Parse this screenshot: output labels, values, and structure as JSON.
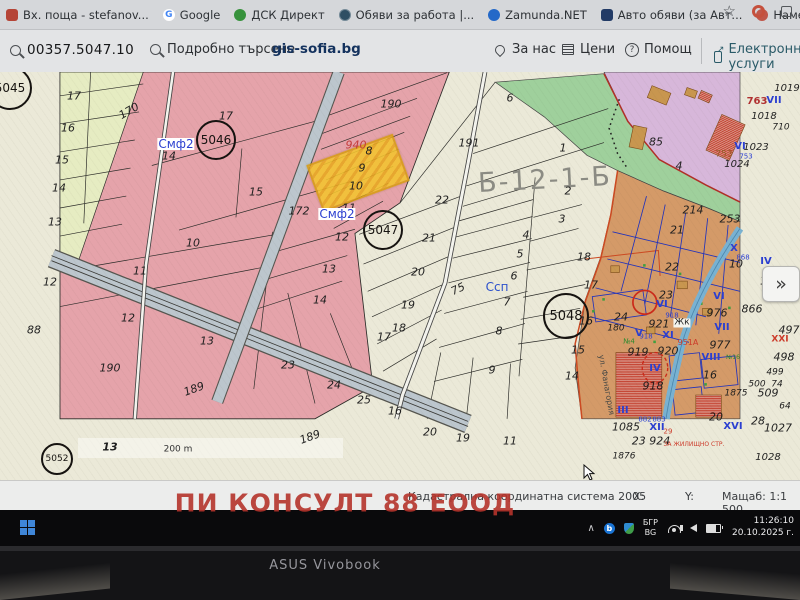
{
  "browser": {
    "bookmarks": [
      {
        "label": "Вх. поща - stefanov...",
        "icon": "mail-icon"
      },
      {
        "label": "Google",
        "icon": "google-icon",
        "glyph": "G"
      },
      {
        "label": "ДСК Директ",
        "icon": "dsk-icon"
      },
      {
        "label": "Обяви за работа |...",
        "icon": "globe-icon"
      },
      {
        "label": "Zamunda.NET",
        "icon": "zamunda-icon"
      },
      {
        "label": "Авто обяви (за Авт...",
        "icon": "auto-icon"
      },
      {
        "label": "Намери Обяви за...",
        "icon": "circle-icon"
      },
      {
        "label": "UBB - Online Banking",
        "icon": "ubb-icon",
        "glyph": "⚓"
      },
      {
        "label": "Единство",
        "icon": "edinstvo-icon"
      }
    ],
    "toolbar": {
      "star": "☆"
    }
  },
  "site_header": {
    "parcel_id": "00357.5047.10",
    "detailed_search": "Подробно търсене",
    "site_name": "gis-sofia.bg",
    "nav": [
      {
        "label": "За нас",
        "icon": "pin-icon"
      },
      {
        "label": "Цени",
        "icon": "doc-icon"
      },
      {
        "label": "Помощ",
        "icon": "help-icon",
        "glyph": "?"
      },
      {
        "label": "Електронни услуги",
        "icon": "ext-link-icon"
      }
    ]
  },
  "map": {
    "expand_button": "»",
    "scale_bar": "200 m",
    "zone_labels_note": "cadastral parcel annotations",
    "circles": [
      {
        "n": "5045",
        "x": 10,
        "y": 88,
        "r": 22,
        "f": 12
      },
      {
        "n": "5046",
        "x": 216,
        "y": 140,
        "r": 20,
        "f": 12
      },
      {
        "n": "5047",
        "x": 383,
        "y": 230,
        "r": 20,
        "f": 12
      },
      {
        "n": "5048",
        "x": 566,
        "y": 316,
        "r": 23,
        "f": 13
      },
      {
        "n": "5052",
        "x": 57,
        "y": 459,
        "r": 16,
        "f": 9
      }
    ],
    "labels": [
      {
        "t": "17",
        "x": 74,
        "y": 96
      },
      {
        "t": "16",
        "x": 68,
        "y": 128
      },
      {
        "t": "15",
        "x": 62,
        "y": 160
      },
      {
        "t": "14",
        "x": 59,
        "y": 188
      },
      {
        "t": "13",
        "x": 55,
        "y": 222
      },
      {
        "t": "12",
        "x": 50,
        "y": 282
      },
      {
        "t": "88",
        "x": 34,
        "y": 330
      },
      {
        "t": "170",
        "x": 129,
        "y": 111,
        "r": -30
      },
      {
        "t": "Смф2",
        "x": 176,
        "y": 144,
        "c": "#2b3fd0",
        "bg": "#ffffff",
        "i": 0,
        "f": 12
      },
      {
        "t": "14",
        "x": 169,
        "y": 156
      },
      {
        "t": "17",
        "x": 226,
        "y": 116
      },
      {
        "t": "15",
        "x": 256,
        "y": 192
      },
      {
        "t": "10",
        "x": 193,
        "y": 243
      },
      {
        "t": "190",
        "x": 391,
        "y": 104
      },
      {
        "t": "940",
        "x": 356,
        "y": 145,
        "c": "#c43a3a"
      },
      {
        "t": "8",
        "x": 369,
        "y": 151
      },
      {
        "t": "9",
        "x": 362,
        "y": 168
      },
      {
        "t": "10",
        "x": 356,
        "y": 186
      },
      {
        "t": "11",
        "x": 349,
        "y": 208
      },
      {
        "t": "172",
        "x": 299,
        "y": 211
      },
      {
        "t": "Смф2",
        "x": 337,
        "y": 214,
        "c": "#2b3fd0",
        "bg": "#ffffff",
        "i": 0,
        "f": 12
      },
      {
        "t": "12",
        "x": 342,
        "y": 237
      },
      {
        "t": "191",
        "x": 469,
        "y": 143
      },
      {
        "t": "6",
        "x": 510,
        "y": 98
      },
      {
        "t": "22",
        "x": 442,
        "y": 200
      },
      {
        "t": "21",
        "x": 429,
        "y": 238
      },
      {
        "t": "20",
        "x": 418,
        "y": 272
      },
      {
        "t": "19",
        "x": 408,
        "y": 305
      },
      {
        "t": "18",
        "x": 399,
        "y": 328
      },
      {
        "t": "17",
        "x": 384,
        "y": 337
      },
      {
        "t": "16",
        "x": 395,
        "y": 411
      },
      {
        "t": "20",
        "x": 430,
        "y": 432
      },
      {
        "t": "19",
        "x": 463,
        "y": 438
      },
      {
        "t": "11",
        "x": 510,
        "y": 441
      },
      {
        "t": "75",
        "x": 458,
        "y": 289,
        "r": -25
      },
      {
        "t": "Ссп",
        "x": 497,
        "y": 287,
        "c": "#2b50cc",
        "i": 0,
        "f": 12
      },
      {
        "t": "Б-12-1-Б",
        "x": 545,
        "y": 180,
        "f": 27,
        "c": "#8b8b83",
        "r": -3,
        "i": 0,
        "ls": 2
      },
      {
        "t": "1",
        "x": 563,
        "y": 148
      },
      {
        "t": "2",
        "x": 568,
        "y": 191
      },
      {
        "t": "3",
        "x": 562,
        "y": 219
      },
      {
        "t": "4",
        "x": 526,
        "y": 235
      },
      {
        "t": "5",
        "x": 520,
        "y": 254
      },
      {
        "t": "6",
        "x": 514,
        "y": 276
      },
      {
        "t": "7",
        "x": 507,
        "y": 302
      },
      {
        "t": "8",
        "x": 499,
        "y": 331
      },
      {
        "t": "9",
        "x": 492,
        "y": 370
      },
      {
        "t": "18",
        "x": 584,
        "y": 257
      },
      {
        "t": "17",
        "x": 591,
        "y": 285
      },
      {
        "t": "16",
        "x": 586,
        "y": 321
      },
      {
        "t": "15",
        "x": 578,
        "y": 350
      },
      {
        "t": "14",
        "x": 572,
        "y": 376
      },
      {
        "t": "24",
        "x": 621,
        "y": 317
      },
      {
        "t": "180",
        "x": 616,
        "y": 329,
        "f": 9
      },
      {
        "t": "85",
        "x": 656,
        "y": 142
      },
      {
        "t": "4",
        "x": 679,
        "y": 166
      },
      {
        "t": "763",
        "x": 757,
        "y": 102,
        "c": "#b03030",
        "i": 0,
        "f": 10,
        "b": 1
      },
      {
        "t": "VII",
        "x": 774,
        "y": 101,
        "c": "#2b3fd0",
        "i": 0,
        "f": 10,
        "b": 1
      },
      {
        "t": "1018",
        "x": 764,
        "y": 117,
        "f": 10
      },
      {
        "t": "1019",
        "x": 787,
        "y": 89,
        "f": 10
      },
      {
        "t": "710",
        "x": 781,
        "y": 128,
        "f": 9
      },
      {
        "t": "VI",
        "x": 740,
        "y": 147,
        "c": "#2b3fd0",
        "i": 0,
        "f": 10,
        "b": 1
      },
      {
        "t": "1023",
        "x": 756,
        "y": 148,
        "f": 10
      },
      {
        "t": "753",
        "x": 724,
        "y": 155,
        "c": "#9a5a28",
        "i": 0,
        "f": 9
      },
      {
        "t": "753",
        "x": 746,
        "y": 157,
        "c": "#2b3fd0",
        "i": 0,
        "f": 7
      },
      {
        "t": "1024",
        "x": 737,
        "y": 165,
        "f": 10
      },
      {
        "t": "214",
        "x": 693,
        "y": 210
      },
      {
        "t": "253",
        "x": 730,
        "y": 219
      },
      {
        "t": "21",
        "x": 677,
        "y": 230
      },
      {
        "t": "22",
        "x": 672,
        "y": 267
      },
      {
        "t": "23",
        "x": 666,
        "y": 295
      },
      {
        "t": "X",
        "x": 734,
        "y": 249,
        "c": "#2b3fd0",
        "i": 0,
        "f": 10,
        "b": 1
      },
      {
        "t": "10",
        "x": 736,
        "y": 264
      },
      {
        "t": "IV",
        "x": 766,
        "y": 262,
        "c": "#2b3fd0",
        "i": 0,
        "f": 10,
        "b": 1
      },
      {
        "t": "11",
        "x": 767,
        "y": 281
      },
      {
        "t": "868",
        "x": 743,
        "y": 258,
        "c": "#2b3fd0",
        "i": 0,
        "f": 7
      },
      {
        "t": "VI",
        "x": 719,
        "y": 297,
        "c": "#2b3fd0",
        "i": 0,
        "f": 10,
        "b": 1
      },
      {
        "t": "VI",
        "x": 662,
        "y": 305,
        "c": "#2b3fd0",
        "i": 0,
        "f": 10,
        "b": 1
      },
      {
        "t": "976",
        "x": 717,
        "y": 313
      },
      {
        "t": "866",
        "x": 752,
        "y": 309
      },
      {
        "t": "VII",
        "x": 722,
        "y": 328,
        "c": "#2b3fd0",
        "i": 0,
        "f": 10,
        "b": 1
      },
      {
        "t": "977",
        "x": 720,
        "y": 345
      },
      {
        "t": "VIII",
        "x": 711,
        "y": 358,
        "c": "#2b3fd0",
        "i": 0,
        "f": 10,
        "b": 1
      },
      {
        "t": "16",
        "x": 710,
        "y": 375
      },
      {
        "t": "918",
        "x": 672,
        "y": 316,
        "c": "#2b3fd0",
        "i": 0,
        "f": 7
      },
      {
        "t": "921",
        "x": 659,
        "y": 324
      },
      {
        "t": "Жк",
        "x": 682,
        "y": 323,
        "bg": "#f5f5ef",
        "i": 0,
        "f": 9
      },
      {
        "t": "V",
        "x": 639,
        "y": 334,
        "c": "#2b3fd0",
        "i": 0,
        "f": 10,
        "b": 1
      },
      {
        "t": "№4",
        "x": 629,
        "y": 342,
        "c": "#2e8b2e",
        "i": 0,
        "f": 7
      },
      {
        "t": "XI",
        "x": 668,
        "y": 336,
        "c": "#2b3fd0",
        "i": 0,
        "f": 10,
        "b": 1
      },
      {
        "t": "919",
        "x": 638,
        "y": 352
      },
      {
        "t": "920",
        "x": 668,
        "y": 351
      },
      {
        "t": "951А",
        "x": 688,
        "y": 343,
        "c": "#cc3b2a",
        "i": 0,
        "f": 8
      },
      {
        "t": "918",
        "x": 646,
        "y": 337,
        "c": "#2b3fd0",
        "i": 0,
        "f": 7
      },
      {
        "t": "№16",
        "x": 733,
        "y": 358,
        "c": "#2e8b2e",
        "i": 0,
        "f": 6
      },
      {
        "t": "IV",
        "x": 655,
        "y": 369,
        "c": "#2b3fd0",
        "i": 0,
        "f": 10,
        "b": 1
      },
      {
        "t": "918",
        "x": 653,
        "y": 386
      },
      {
        "t": "III",
        "x": 623,
        "y": 411,
        "c": "#2b3fd0",
        "i": 0,
        "f": 10,
        "b": 1
      },
      {
        "t": "1085",
        "x": 626,
        "y": 427
      },
      {
        "t": "882",
        "x": 645,
        "y": 420,
        "c": "#2b3fd0",
        "i": 0,
        "f": 7
      },
      {
        "t": "883",
        "x": 659,
        "y": 420,
        "c": "#2b3fd0",
        "i": 0,
        "f": 7
      },
      {
        "t": "XII",
        "x": 657,
        "y": 428,
        "c": "#2b3fd0",
        "i": 0,
        "f": 10,
        "b": 1
      },
      {
        "t": "23 924",
        "x": 651,
        "y": 441
      },
      {
        "t": "29",
        "x": 668,
        "y": 432,
        "c": "#cc3b2a",
        "i": 0,
        "f": 7
      },
      {
        "t": "1876",
        "x": 624,
        "y": 457,
        "f": 9
      },
      {
        "t": "20",
        "x": 716,
        "y": 417
      },
      {
        "t": "1875",
        "x": 736,
        "y": 394,
        "f": 9
      },
      {
        "t": "XVI",
        "x": 733,
        "y": 427,
        "c": "#2b3fd0",
        "i": 0,
        "f": 10,
        "b": 1
      },
      {
        "t": "509",
        "x": 768,
        "y": 393
      },
      {
        "t": "500",
        "x": 757,
        "y": 385,
        "f": 9
      },
      {
        "t": "74",
        "x": 777,
        "y": 385,
        "f": 9
      },
      {
        "t": "28",
        "x": 758,
        "y": 421
      },
      {
        "t": "1027",
        "x": 778,
        "y": 428
      },
      {
        "t": "497",
        "x": 789,
        "y": 330
      },
      {
        "t": "XXI",
        "x": 780,
        "y": 340,
        "c": "#cc3b2a",
        "i": 0,
        "f": 9,
        "b": 1
      },
      {
        "t": "498",
        "x": 784,
        "y": 357
      },
      {
        "t": "499",
        "x": 775,
        "y": 373,
        "f": 9
      },
      {
        "t": "64",
        "x": 785,
        "y": 407,
        "f": 9
      },
      {
        "t": "1028",
        "x": 768,
        "y": 458,
        "f": 10
      },
      {
        "t": "ЗА ЖИЛИЩНО СТР.",
        "x": 694,
        "y": 445,
        "c": "#cc3b2a",
        "i": 0,
        "f": 6
      },
      {
        "t": "ул. Фанагория",
        "x": 606,
        "y": 385,
        "c": "#4a4a46",
        "i": 0,
        "f": 8,
        "r": 80
      },
      {
        "t": "190",
        "x": 110,
        "y": 368
      },
      {
        "t": "189",
        "x": 194,
        "y": 389,
        "r": -20
      },
      {
        "t": "13",
        "x": 207,
        "y": 341
      },
      {
        "t": "12",
        "x": 128,
        "y": 318
      },
      {
        "t": "11",
        "x": 140,
        "y": 271
      },
      {
        "t": "23",
        "x": 288,
        "y": 365
      },
      {
        "t": "24",
        "x": 334,
        "y": 385
      },
      {
        "t": "25",
        "x": 364,
        "y": 400
      },
      {
        "t": "14",
        "x": 320,
        "y": 300
      },
      {
        "t": "13",
        "x": 329,
        "y": 269
      },
      {
        "t": "13",
        "x": 110,
        "y": 447,
        "b": 1
      },
      {
        "t": "189",
        "x": 310,
        "y": 437,
        "r": -20
      },
      {
        "t": "200 m",
        "x": 178,
        "y": 450,
        "f": 9,
        "i": 0,
        "c": "#333333"
      }
    ]
  },
  "statusbar": {
    "coord_system": "Кадастрална координатна система 2005",
    "x_label": "X:",
    "y_label": "Y:",
    "scale": "Мащаб: 1:1 500"
  },
  "watermark": "ПИ КОНСУЛТ 88 ЕООД",
  "taskbar": {
    "chevron": "∧",
    "lang1": "БГР",
    "lang2": "BG",
    "time": "11:26:10",
    "date": "20.10.2025 г.",
    "bt_glyph": "b"
  },
  "laptop": {
    "brand": "ASUS Vivobook"
  }
}
